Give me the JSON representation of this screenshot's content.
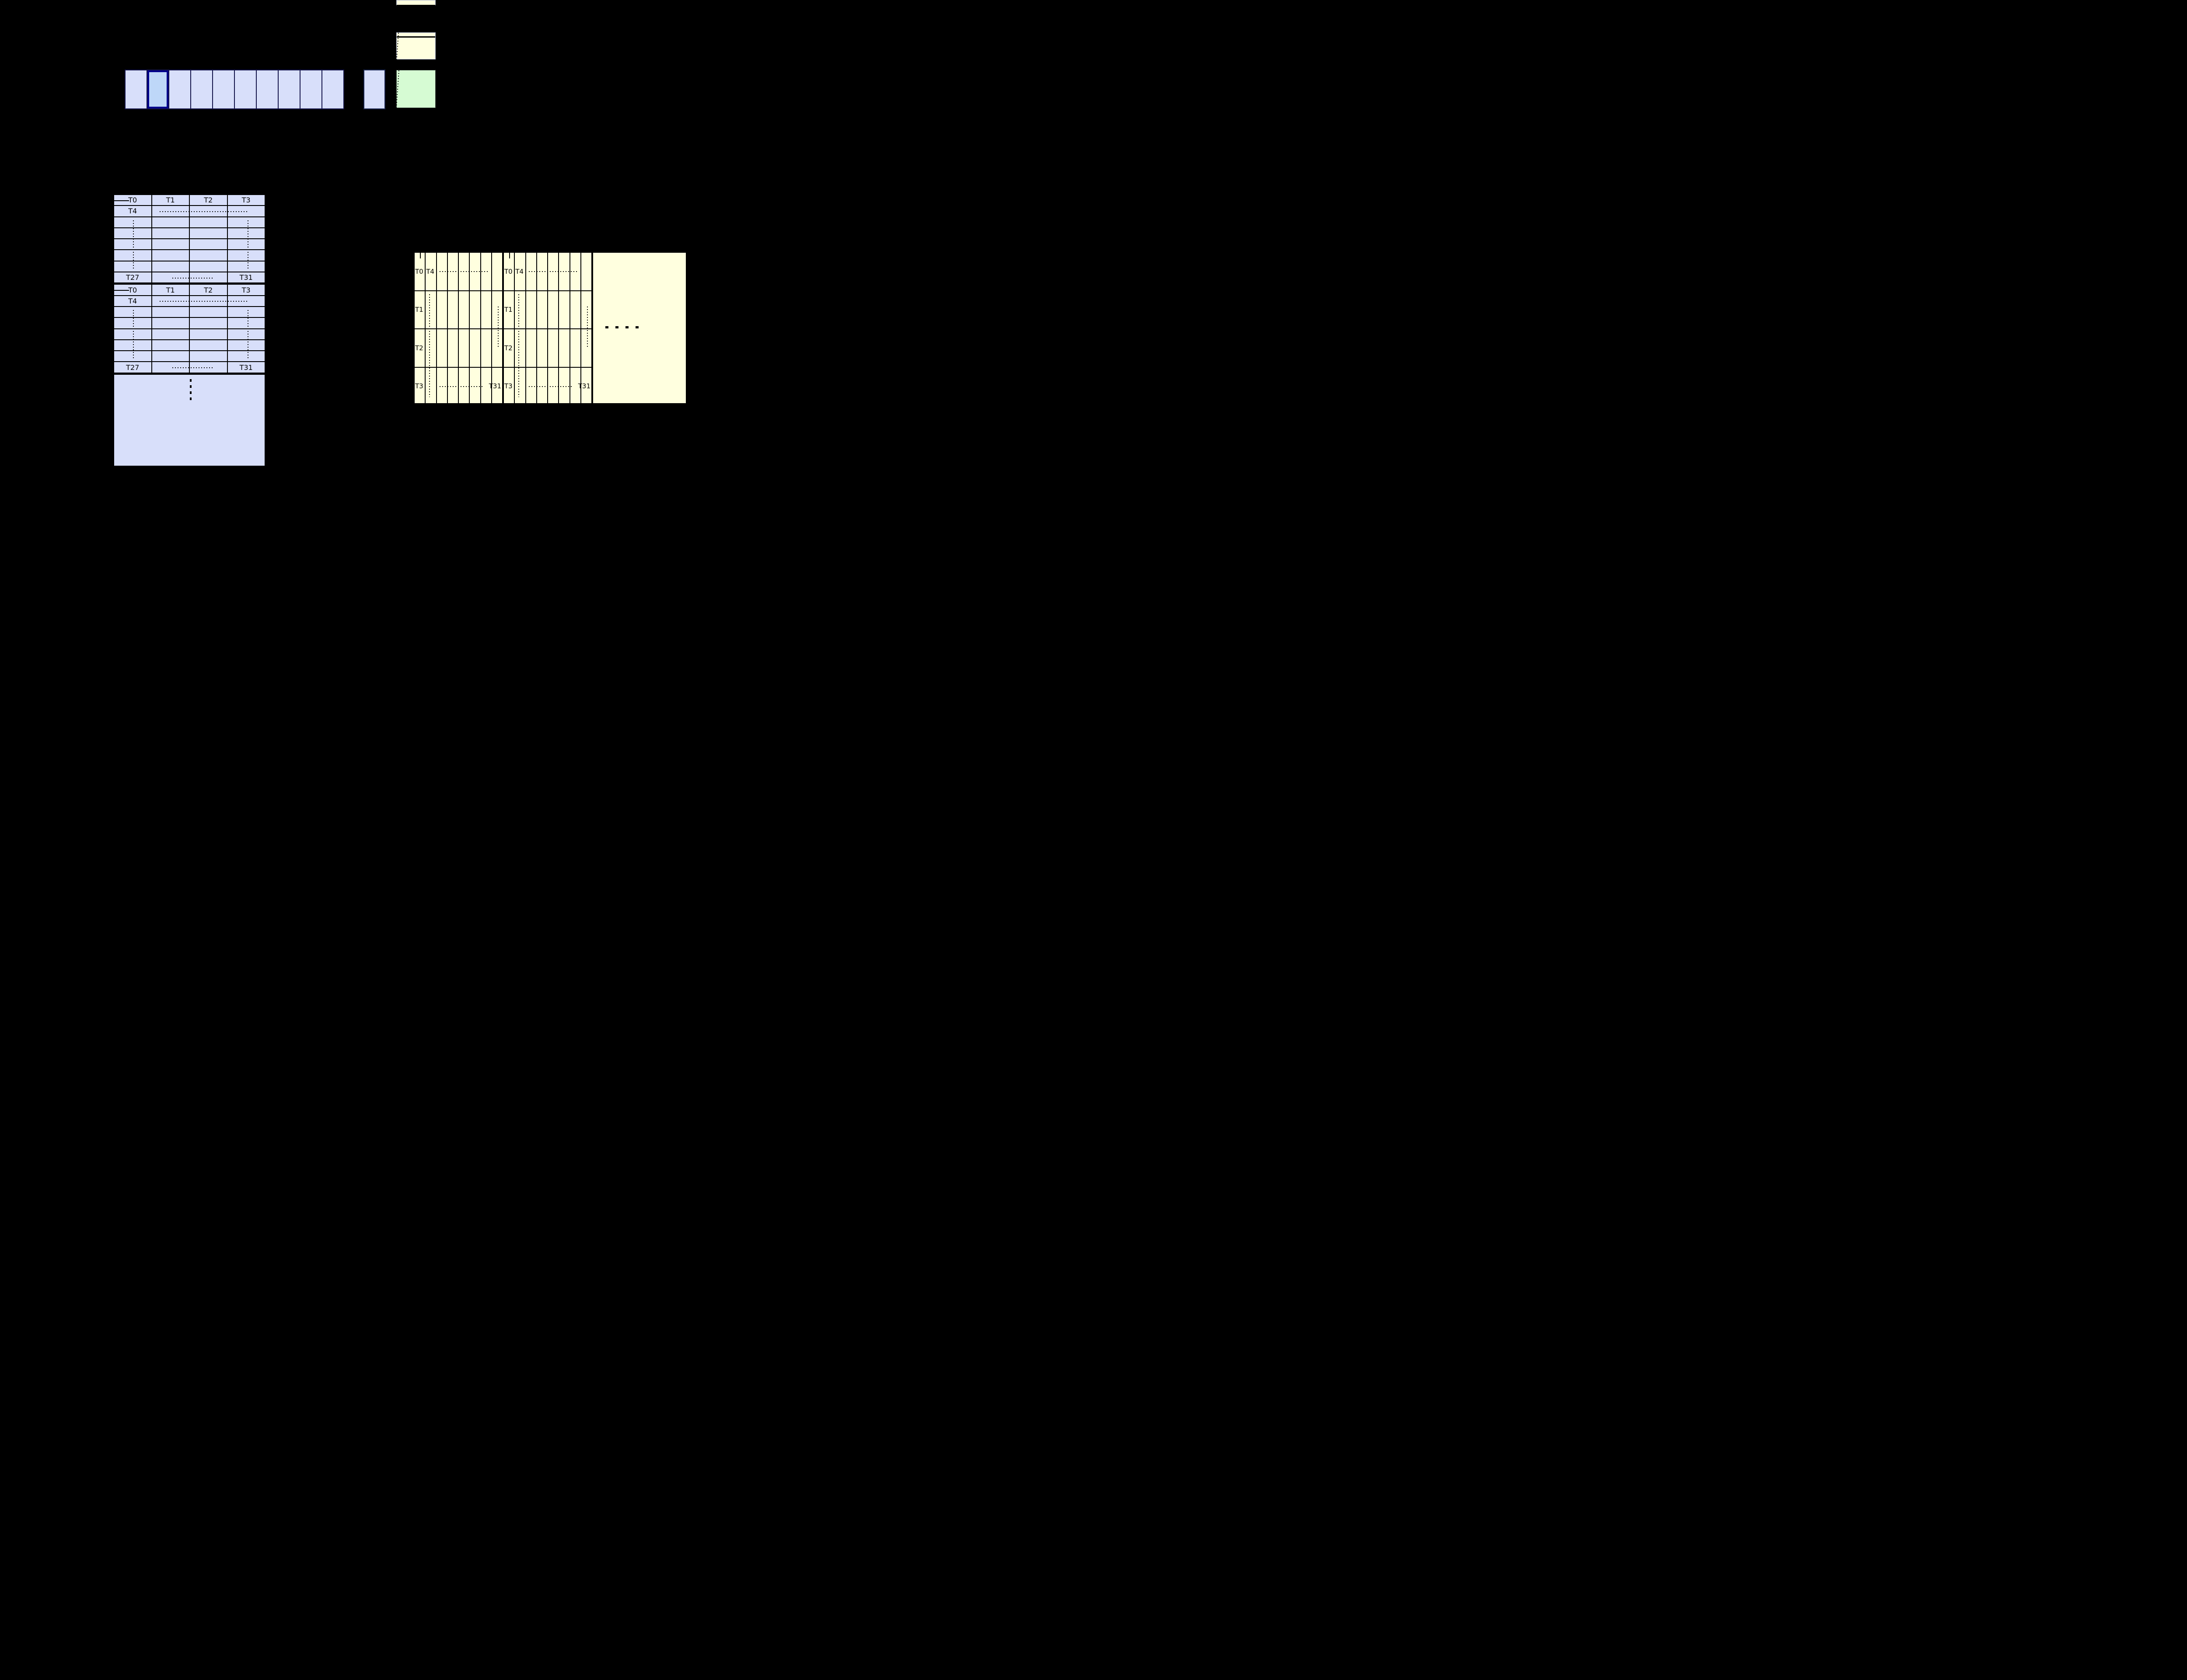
{
  "page": {
    "background": "#000000"
  },
  "memory_row": {
    "cell_count": 10,
    "highlighted_index": 1,
    "fill": "#d8dffa",
    "highlight_fill": "#bed7f8",
    "highlight_border": "#00008b"
  },
  "left_table": {
    "fill": "#d8dffa",
    "block_count": 2,
    "header_labels": [
      "T0",
      "T1",
      "T2",
      "T3"
    ],
    "second_row_label": "T4",
    "last_row_first_label": "T27",
    "last_row_last_label": "T31",
    "ellipsis_dot_count": 4
  },
  "right_table": {
    "fill": "#ffffdf",
    "block_count": 2,
    "row_labels": [
      "T0",
      "T1",
      "T2",
      "T3"
    ],
    "first_row_second_label": "T4",
    "last_label": "T31",
    "ellipsis_dot_count": 4
  },
  "zoom_boxes": {
    "yellow_fill": "#ffffdf",
    "green_fill": "#d6fbd3"
  }
}
